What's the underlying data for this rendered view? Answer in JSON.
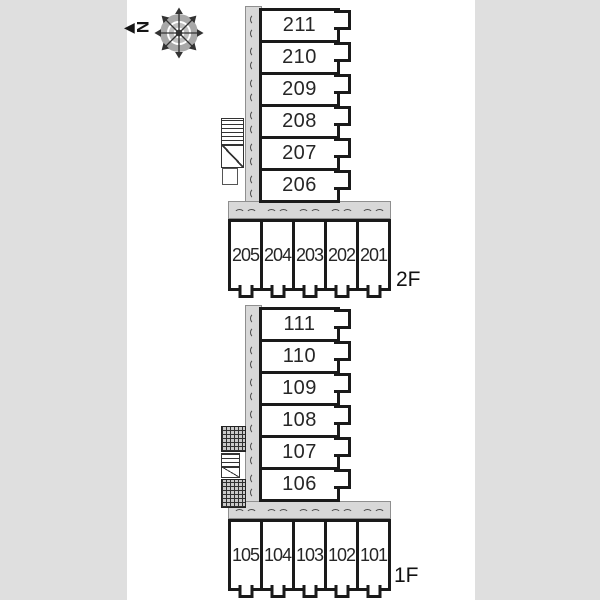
{
  "compass": {
    "letter": "N"
  },
  "floor_2f": {
    "label": "2F",
    "stack": [
      "211",
      "210",
      "209",
      "208",
      "207",
      "206"
    ],
    "row": [
      "205",
      "204",
      "203",
      "202",
      "201"
    ]
  },
  "floor_1f": {
    "label": "1F",
    "stack": [
      "111",
      "110",
      "109",
      "108",
      "107",
      "106"
    ],
    "row": [
      "105",
      "104",
      "103",
      "102",
      "101"
    ]
  },
  "colors": {
    "background": "#dfdfdf",
    "sheet": "#ffffff",
    "corridor": "#d8d8d8",
    "wall": "#1a1a1a"
  }
}
